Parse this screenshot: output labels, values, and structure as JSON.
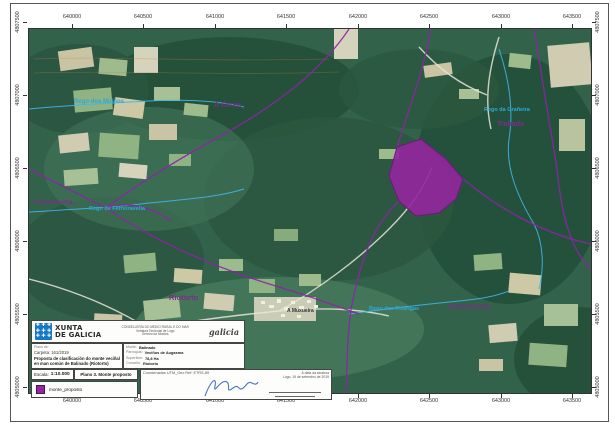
{
  "document": {
    "type": "map-sheet",
    "sheet_title": "Plano 3. Monte proposto"
  },
  "colors": {
    "accent_purple": "#8e24aa",
    "polygon_fill": "#93279c",
    "stream_blue": "#2fa8d8",
    "xunta_blue": "#1779c4",
    "signature_blue": "#2b5fb8",
    "forest_green": "#33624a"
  },
  "grid": {
    "top": {
      "y": 17,
      "xs": [
        72,
        143,
        215,
        286,
        358,
        429,
        501,
        572
      ],
      "labels": [
        "640000",
        "640500",
        "641000",
        "641500",
        "642000",
        "642500",
        "643000",
        "643500"
      ]
    },
    "bottom": {
      "y": 401,
      "xs": [
        72,
        143,
        215,
        286,
        358,
        429,
        501,
        572
      ],
      "labels": [
        "640000",
        "640500",
        "641000",
        "641500",
        "642000",
        "642500",
        "643000",
        "643500"
      ]
    },
    "left": {
      "x": 18,
      "ys": [
        22,
        95,
        168,
        241,
        314,
        387
      ],
      "labels": [
        "4807500",
        "4807000",
        "4806500",
        "4806000",
        "4805500",
        "4805000"
      ]
    },
    "right": {
      "x": 598,
      "ys": [
        22,
        95,
        168,
        241,
        314,
        387
      ],
      "labels": [
        "4807500",
        "4807000",
        "4806500",
        "4806000",
        "4805500",
        "4805000"
      ]
    }
  },
  "map_labels": {
    "orrea": {
      "text": "A Órrea"
    },
    "trabada": {
      "text": "Trabada"
    },
    "ferreiravella": {
      "text": "Ferreiravella"
    },
    "riotorto": {
      "text": "Riotorto"
    },
    "pontenova": {
      "text": "A Pontenova"
    },
    "muxueira": {
      "text": "A Muxueira"
    },
    "stream_nw": {
      "text": "Rego dos Muíños"
    },
    "stream_w": {
      "text": "Rego de Ferreiravella"
    },
    "stream_s": {
      "text": "Rego das Rodrigas"
    },
    "stream_ne": {
      "text": "Rego da Grañeira"
    }
  },
  "title_block": {
    "org": {
      "name_line1": "XUNTA",
      "name_line2": "DE GALICIA",
      "dept_line1": "CONSELLERÍA DO MEDIO RURAL E DO MAR",
      "dept_line2": "Xefatura Territorial de Lugo",
      "dept_line3": "Servizo de Montes",
      "brand": "galicia"
    },
    "plan": {
      "label": "Plano de:",
      "carpeta": "Carpeta: 161/2019",
      "title": "Proposta de clasificación do monte veciñal en man común de Balinado (Riotorto)"
    },
    "fields": {
      "monte_label": "Monte:",
      "monte_value": "Balinado",
      "parroquia_label": "Parroquia:",
      "parroquia_value": "Veciños de Augasma",
      "superficie_label": "Superficie:",
      "superficie_value": "78,8 Ha",
      "concello_label": "Concello:",
      "concello_value": "Riotorto"
    },
    "escala_label": "Escala:",
    "escala_value": "1:10.000",
    "plano_num": "Plano 3. Monte proposto",
    "coords_label": "Coordenadas UTM_Geo Ref: ETRS-89",
    "date_line1": "Á data da sinatura",
    "date_line2": "Lugo, 15 de setembro de 2019",
    "legend": {
      "swatch_color": "#93279c",
      "label": "monte_proposto"
    }
  }
}
